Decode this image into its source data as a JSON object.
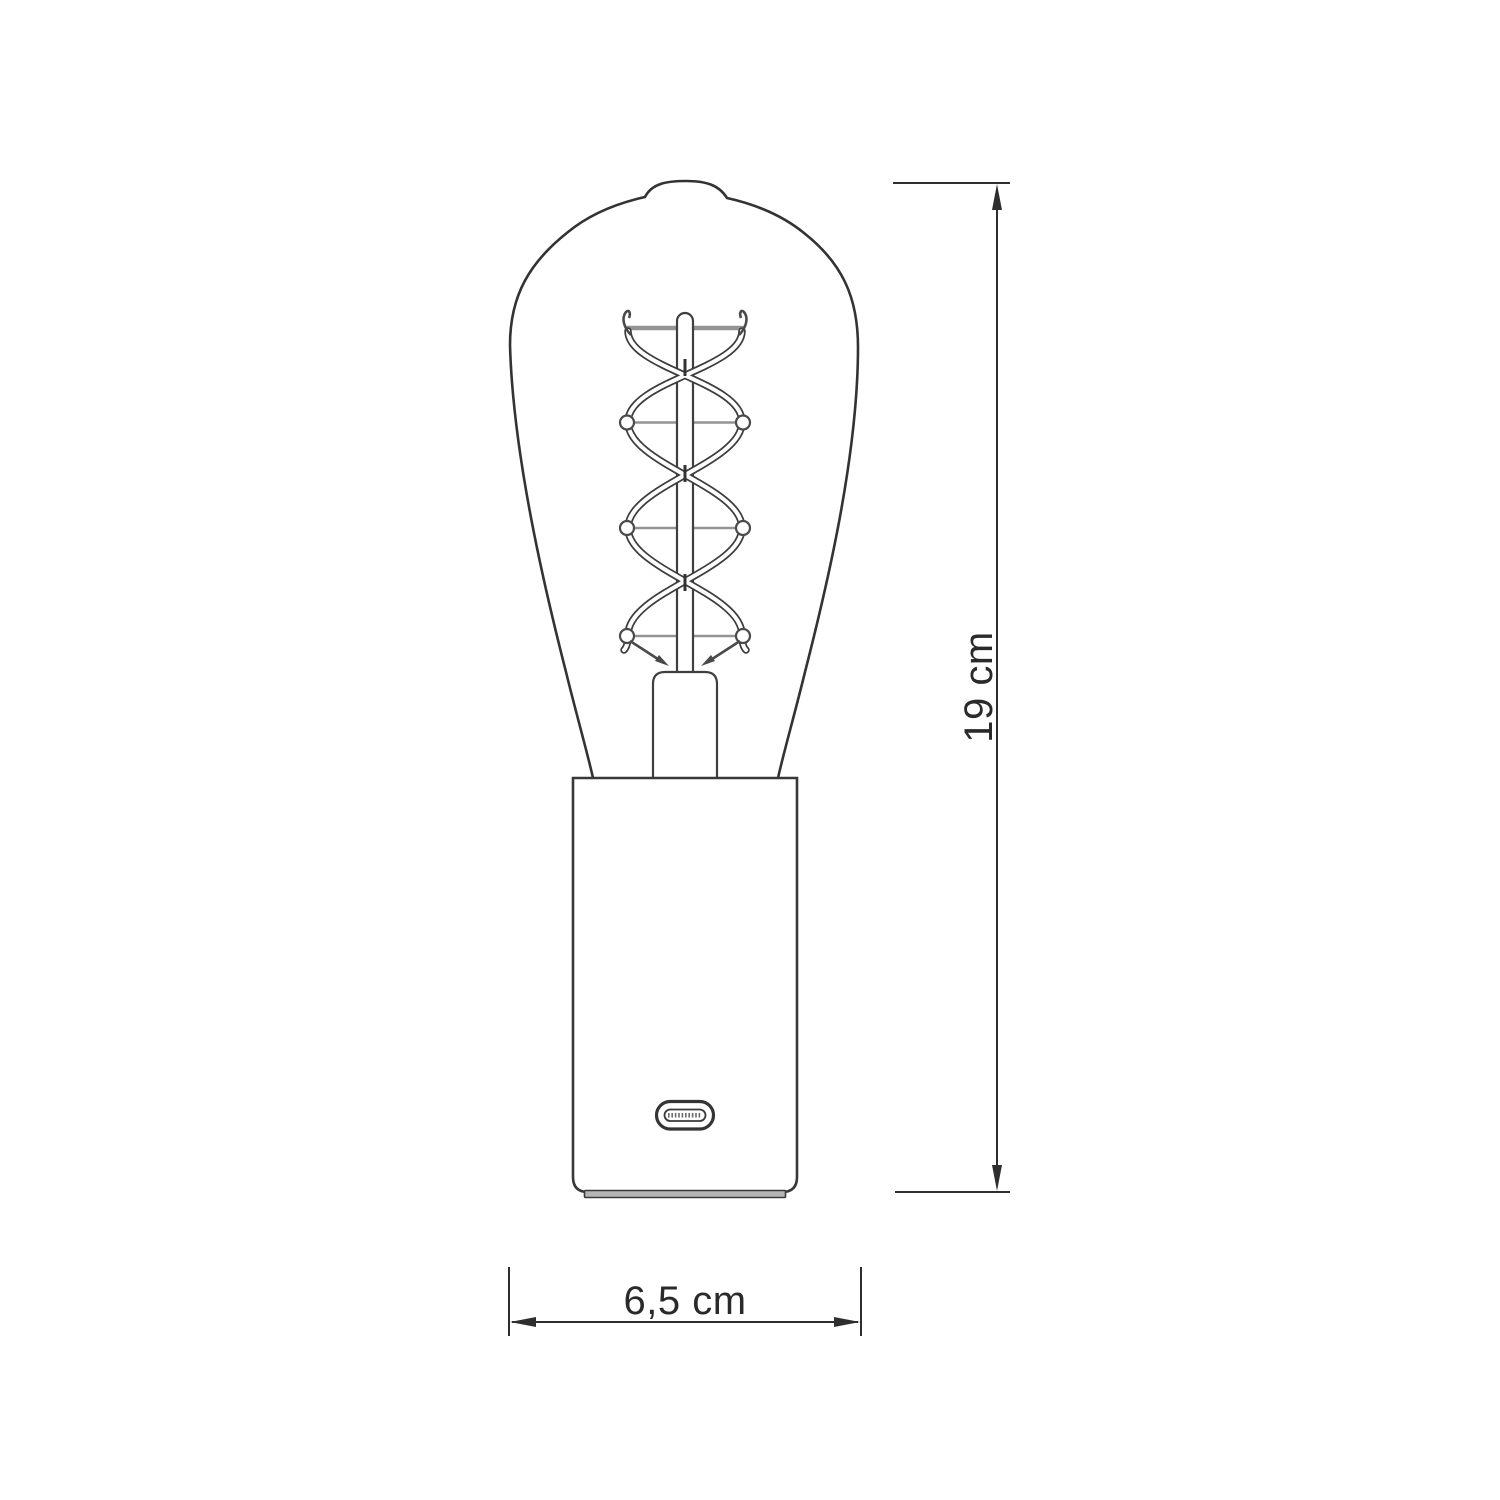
{
  "diagram": {
    "kind": "technical dimension drawing",
    "subject": "table lamp with spiral-filament Edison bulb and USB-C port on cylindrical base",
    "dimensions": {
      "height_label": "19 cm",
      "width_label": "6,5 cm"
    },
    "colors": {
      "line": "#333333",
      "support_wire": "#949494",
      "dimension": "#2e2e2e",
      "text": "#2a2a2a",
      "background": "#ffffff"
    }
  }
}
